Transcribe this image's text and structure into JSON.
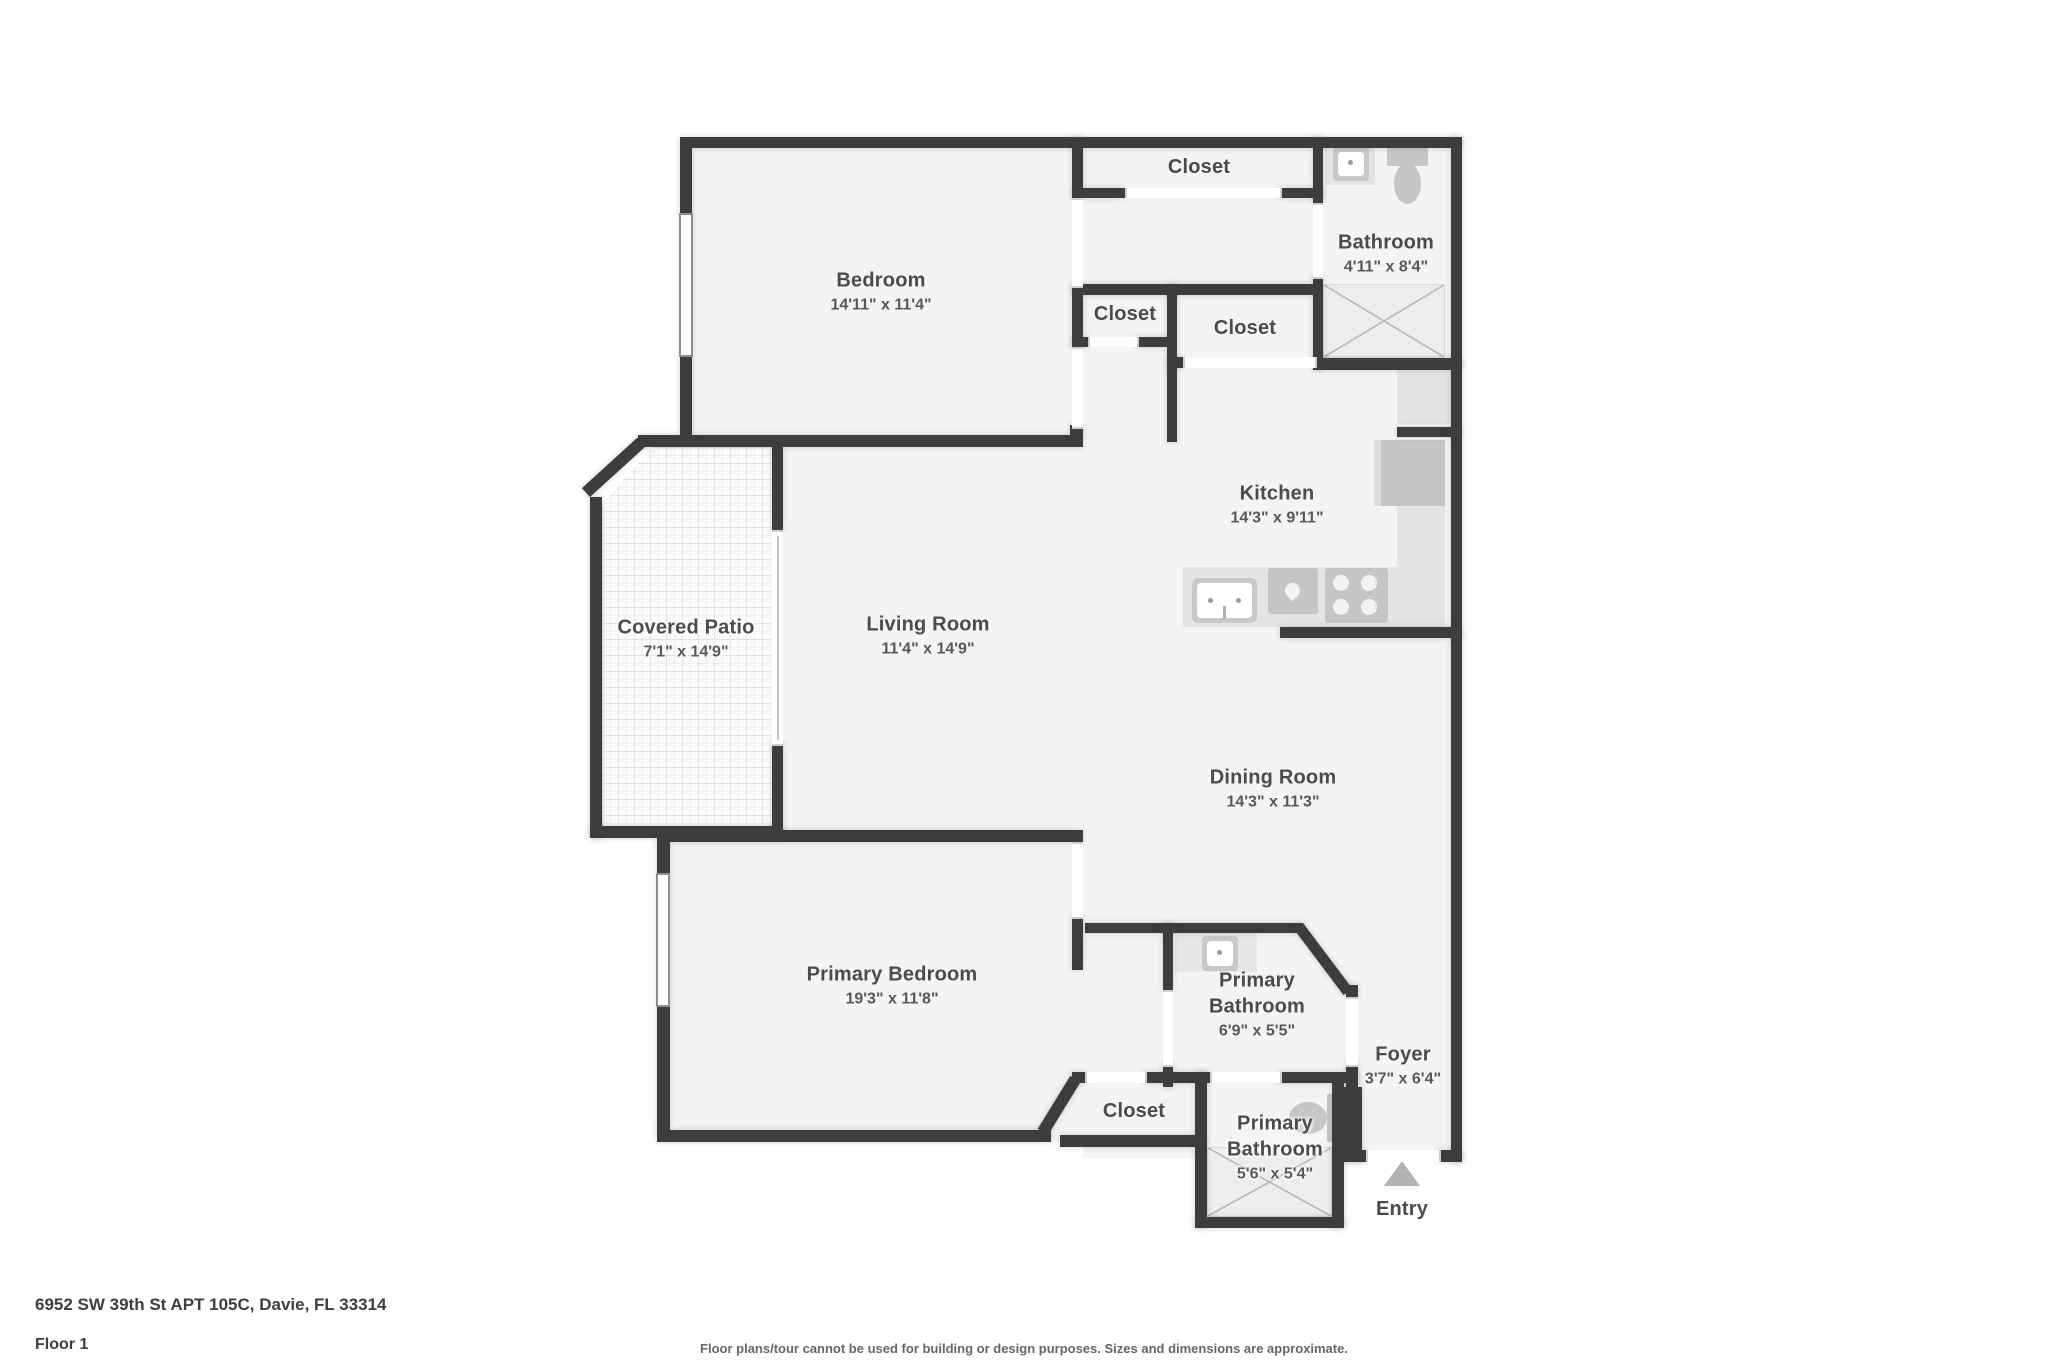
{
  "title": "Floor plan - 6952 SW 39th St APT 105C",
  "colors": {
    "wall": "#3d3d3d",
    "floor": "#f4f4f4",
    "fixture": "#c6c6c6",
    "counter": "#e4e4e4",
    "shower": "#ededed",
    "label_text": "#4b4b4b",
    "footer_text": "#3e3e3e",
    "disclaimer_text": "#666666"
  },
  "rooms": [
    {
      "id": "bedroom",
      "name": "Bedroom",
      "dims": "14'11\" x 11'4\""
    },
    {
      "id": "closet-top",
      "name": "Closet",
      "dims": ""
    },
    {
      "id": "bathroom",
      "name": "Bathroom",
      "dims": "4'11\" x 8'4\""
    },
    {
      "id": "closet-small",
      "name": "Closet",
      "dims": ""
    },
    {
      "id": "closet-wide",
      "name": "Closet",
      "dims": ""
    },
    {
      "id": "kitchen",
      "name": "Kitchen",
      "dims": "14'3\" x 9'11\""
    },
    {
      "id": "covered-patio",
      "name": "Covered Patio",
      "dims": "7'1\" x 14'9\""
    },
    {
      "id": "living-room",
      "name": "Living Room",
      "dims": "11'4\" x 14'9\""
    },
    {
      "id": "dining-room",
      "name": "Dining Room",
      "dims": "14'3\" x 11'3\""
    },
    {
      "id": "primary-bedroom",
      "name": "Primary Bedroom",
      "dims": "19'3\" x 11'8\""
    },
    {
      "id": "primary-bathroom-upper",
      "name": "Primary Bathroom",
      "dims": "6'9\" x 5'5\""
    },
    {
      "id": "foyer",
      "name": "Foyer",
      "dims": "3'7\" x 6'4\""
    },
    {
      "id": "closet-bottom",
      "name": "Closet",
      "dims": ""
    },
    {
      "id": "primary-bathroom-lower",
      "name": "Primary Bathroom",
      "dims": "5'6\" x 5'4\""
    },
    {
      "id": "entry",
      "name": "Entry",
      "dims": ""
    }
  ],
  "icons": {
    "bathroom_sink": "sink-icon",
    "bathroom_toilet": "toilet-icon",
    "bathroom_shower": "shower-icon",
    "kitchen_sink": "kitchen-sink-icon",
    "kitchen_dishwasher": "dishwasher-icon",
    "kitchen_stove": "stove-icon",
    "kitchen_refrigerator": "refrigerator-icon",
    "entry_marker": "entry-arrow-icon",
    "patio_surface": "tile-pattern"
  },
  "footer": {
    "address": "6952 SW 39th St APT 105C, Davie, FL 33314",
    "floor": "Floor 1",
    "disclaimer": "Floor plans/tour cannot be used for building or design purposes. Sizes and dimensions are approximate."
  }
}
